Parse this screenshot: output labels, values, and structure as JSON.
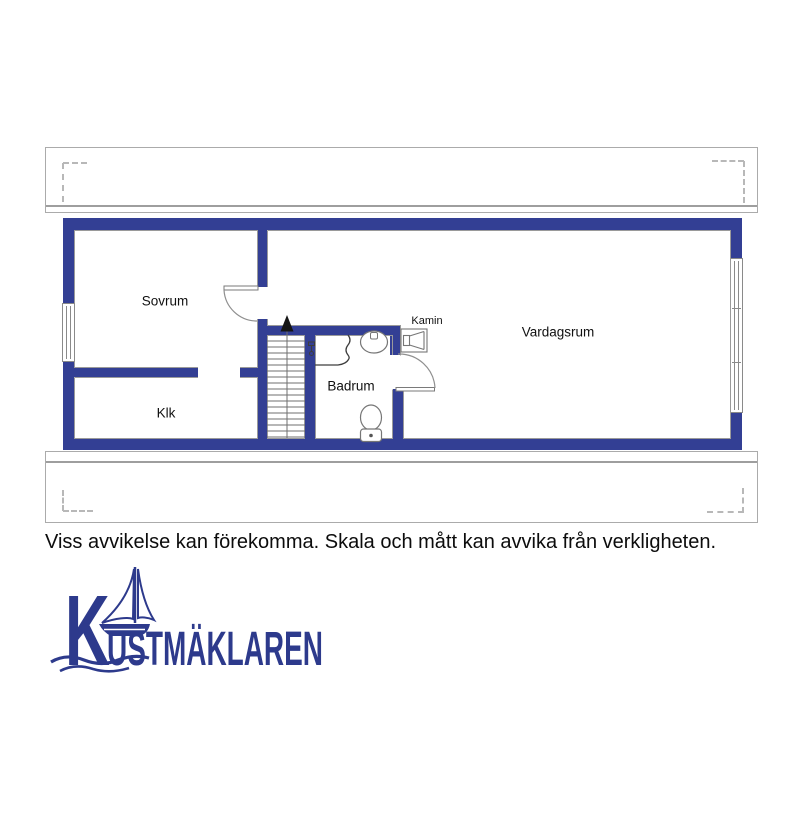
{
  "floorplan": {
    "rooms": [
      {
        "name": "sovrum",
        "label": "Sovrum"
      },
      {
        "name": "klk",
        "label": "Klk"
      },
      {
        "name": "badrum",
        "label": "Badrum"
      },
      {
        "name": "vardagsrum",
        "label": "Vardagsrum"
      }
    ],
    "fixtures": {
      "fireplace_label": "Kamin"
    },
    "colors": {
      "wall_blue": "#333f94",
      "fixture_gray": "#767676",
      "terrace_gray": "#ababab"
    }
  },
  "disclaimer": "Viss avvikelse kan förekomma. Skala och mått kan avvika från verkligheten.",
  "logo": {
    "brand": "Kustmäklaren",
    "display_initial": "K",
    "display_rest": "USTMÄKLAREN",
    "color": "#2d3a8c"
  }
}
